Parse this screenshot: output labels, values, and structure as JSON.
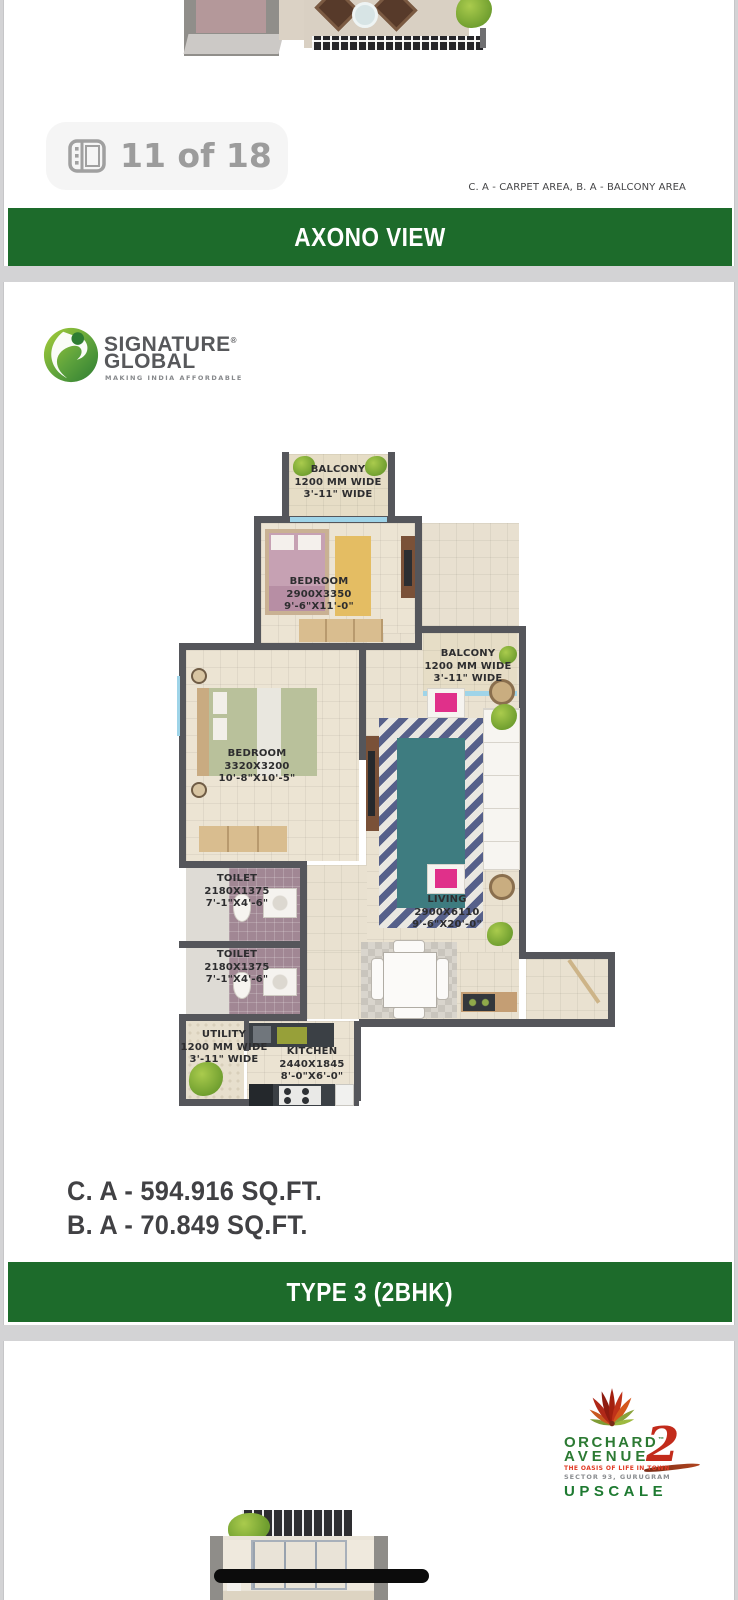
{
  "viewer": {
    "page_badge": "11 of 18"
  },
  "axono_page": {
    "caption": "C. A - CARPET AREA, B. A - BALCONY AREA",
    "banner": "AXONO VIEW"
  },
  "brand": {
    "name_line1": "SIGNATURE",
    "name_line2": "GLOBAL",
    "registered_mark": "®",
    "tagline": "MAKING INDIA AFFORDABLE"
  },
  "floor_plan": {
    "rooms": {
      "balcony_top": {
        "name": "BALCONY",
        "dim1": "1200 MM WIDE",
        "dim2": "3'-11\" WIDE"
      },
      "bedroom_1": {
        "name": "BEDROOM",
        "dim1": "2900X3350",
        "dim2": "9'-6\"X11'-0\""
      },
      "balcony_right": {
        "name": "BALCONY",
        "dim1": "1200 MM WIDE",
        "dim2": "3'-11\" WIDE"
      },
      "bedroom_2": {
        "name": "BEDROOM",
        "dim1": "3320X3200",
        "dim2": "10'-8\"X10'-5\""
      },
      "toilet_1": {
        "name": "TOILET",
        "dim1": "2180X1375",
        "dim2": "7'-1\"X4'-6\""
      },
      "toilet_2": {
        "name": "TOILET",
        "dim1": "2180X1375",
        "dim2": "7'-1\"X4'-6\""
      },
      "living": {
        "name": "LIVING",
        "dim1": "2900X6110",
        "dim2": "9'-6\"X20'-0\""
      },
      "utility": {
        "name": "UTILITY",
        "dim1": "1200 MM WIDE",
        "dim2": "3'-11\" WIDE"
      },
      "kitchen": {
        "name": "KITCHEN",
        "dim1": "2440X1845",
        "dim2": "8'-0\"X6'-0\""
      }
    }
  },
  "areas": {
    "carpet": "C. A - 594.916 SQ.FT.",
    "balcony": "B. A - 70.849 SQ.FT."
  },
  "type_banner": "TYPE 3 (2BHK)",
  "project": {
    "name_line1": "ORCHARD",
    "trademark": "™",
    "name_line2": "AVENUE",
    "number": "2",
    "tagline1": "THE OASIS OF LIFE IN TOWN",
    "tagline2": "SECTOR 93, GURUGRAM",
    "tagline3": "UPSCALE"
  },
  "colors": {
    "banner_green": "#1d6b2b",
    "brand_green": "#3f9240",
    "project_green": "#2c7a33",
    "accent_pink": "#e0308a",
    "wall_grey": "#55565b"
  }
}
